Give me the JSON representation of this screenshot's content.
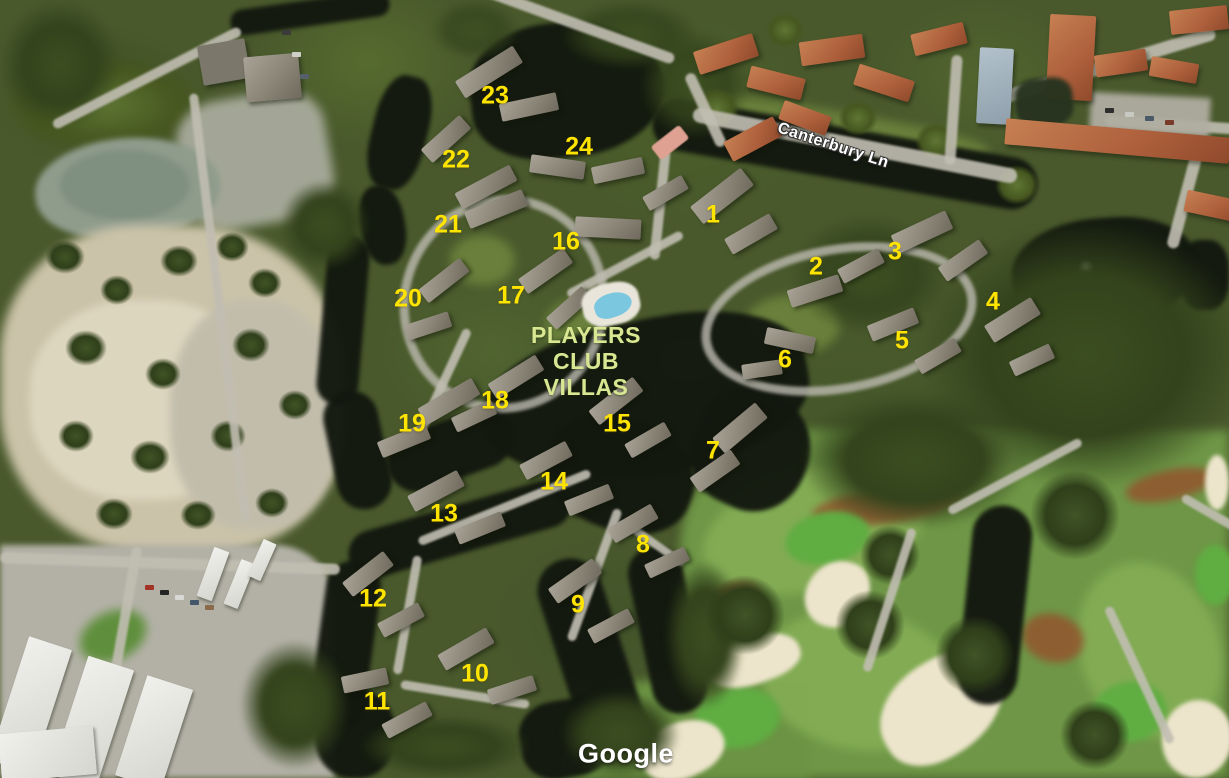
{
  "map": {
    "view": "satellite-aerial-3d",
    "watermark": "Google",
    "street_label": "Canterbury Ln",
    "street_label_pos": {
      "x": 833,
      "y": 146,
      "rotation_deg": 18
    },
    "place_label_lines": [
      "PLAYERS",
      "CLUB",
      "VILLAS"
    ],
    "place_label_pos": {
      "x": 586,
      "y": 361
    },
    "watermark_pos": {
      "x": 626,
      "y": 754
    },
    "colors": {
      "marker_yellow": "#ffe400",
      "place_label_green": "#d9e792",
      "street_label_white": "#ffffff",
      "watermark_white": "#ffffff",
      "water_dark": "#13180f",
      "golf_green": "#6e9646",
      "sand_clearing": "#cbc3a9",
      "bunker_sand": "#ece4cb",
      "terracotta_roof": "#ad5f3b",
      "villa_roof": "#8a8577",
      "pool_blue": "#7bc7e0"
    },
    "villa_markers": [
      {
        "label": "1",
        "x": 713,
        "y": 215
      },
      {
        "label": "2",
        "x": 816,
        "y": 267
      },
      {
        "label": "3",
        "x": 895,
        "y": 252
      },
      {
        "label": "4",
        "x": 993,
        "y": 302
      },
      {
        "label": "5",
        "x": 902,
        "y": 341
      },
      {
        "label": "6",
        "x": 785,
        "y": 360
      },
      {
        "label": "7",
        "x": 713,
        "y": 451
      },
      {
        "label": "8",
        "x": 643,
        "y": 545
      },
      {
        "label": "9",
        "x": 578,
        "y": 605
      },
      {
        "label": "10",
        "x": 475,
        "y": 674
      },
      {
        "label": "11",
        "x": 377,
        "y": 702
      },
      {
        "label": "12",
        "x": 373,
        "y": 599
      },
      {
        "label": "13",
        "x": 444,
        "y": 514
      },
      {
        "label": "14",
        "x": 554,
        "y": 482
      },
      {
        "label": "15",
        "x": 617,
        "y": 424
      },
      {
        "label": "16",
        "x": 566,
        "y": 242
      },
      {
        "label": "17",
        "x": 511,
        "y": 296
      },
      {
        "label": "18",
        "x": 495,
        "y": 401
      },
      {
        "label": "19",
        "x": 412,
        "y": 424
      },
      {
        "label": "20",
        "x": 408,
        "y": 299
      },
      {
        "label": "21",
        "x": 448,
        "y": 225
      },
      {
        "label": "22",
        "x": 456,
        "y": 160
      },
      {
        "label": "23",
        "x": 495,
        "y": 96
      },
      {
        "label": "24",
        "x": 579,
        "y": 147
      }
    ]
  }
}
